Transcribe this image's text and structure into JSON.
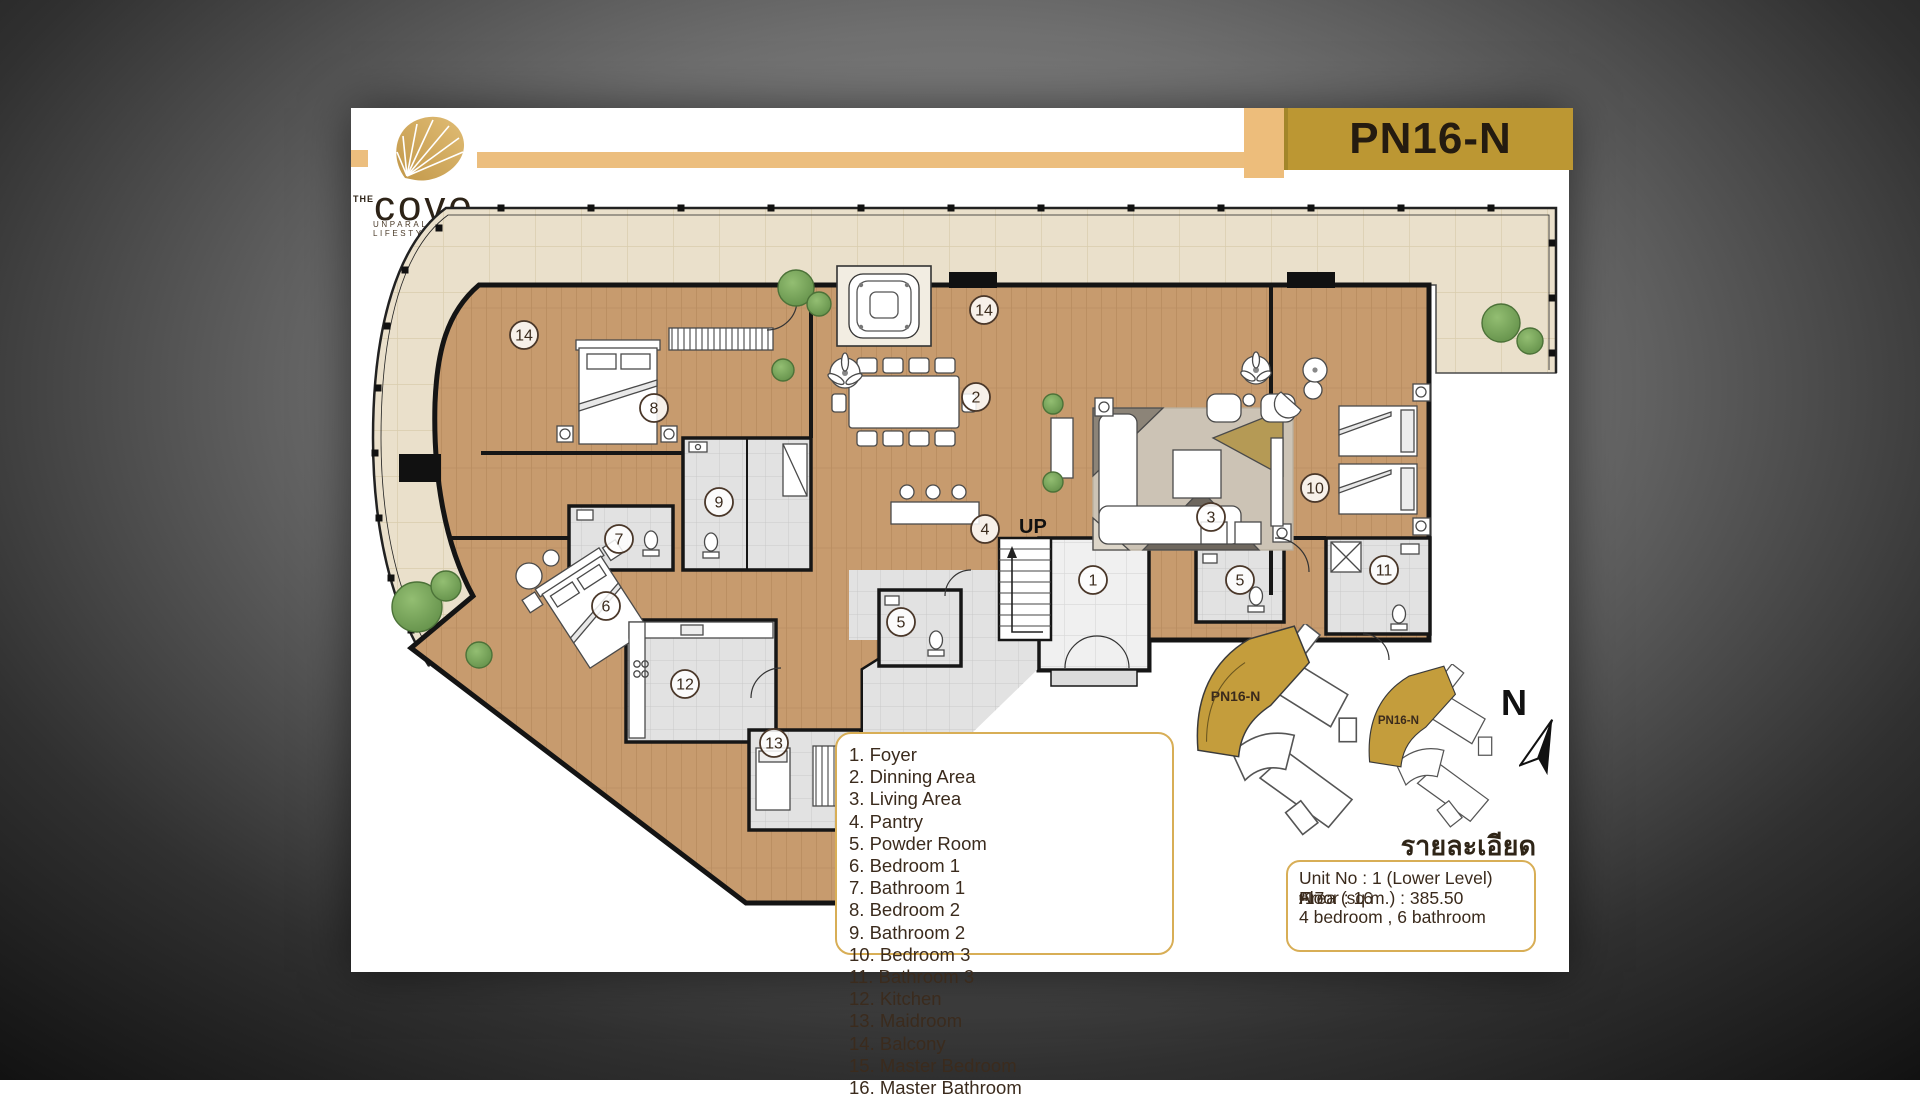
{
  "brand": {
    "the": "THE",
    "name": "cove",
    "tagline": "UNPARALLELED LIFESTYLE"
  },
  "unit_code": "PN16-N",
  "plan": {
    "up_label": "UP",
    "markers": [
      {
        "n": "14",
        "x": 173,
        "y": 227
      },
      {
        "n": "14",
        "x": 633,
        "y": 202
      },
      {
        "n": "8",
        "x": 303,
        "y": 300
      },
      {
        "n": "2",
        "x": 625,
        "y": 289
      },
      {
        "n": "3",
        "x": 860,
        "y": 409
      },
      {
        "n": "10",
        "x": 964,
        "y": 380
      },
      {
        "n": "9",
        "x": 368,
        "y": 394
      },
      {
        "n": "7",
        "x": 268,
        "y": 431
      },
      {
        "n": "6",
        "x": 255,
        "y": 498
      },
      {
        "n": "12",
        "x": 334,
        "y": 576
      },
      {
        "n": "13",
        "x": 423,
        "y": 635
      },
      {
        "n": "5",
        "x": 550,
        "y": 514
      },
      {
        "n": "5",
        "x": 889,
        "y": 472
      },
      {
        "n": "1",
        "x": 742,
        "y": 472
      },
      {
        "n": "4",
        "x": 634,
        "y": 421
      },
      {
        "n": "11",
        "x": 1033,
        "y": 462
      }
    ]
  },
  "legend": {
    "col1": [
      {
        "num": "1.",
        "label": "Foyer"
      },
      {
        "num": "2.",
        "label": "Dinning Area"
      },
      {
        "num": "3.",
        "label": "Living Area"
      },
      {
        "num": "4.",
        "label": "Pantry"
      },
      {
        "num": "5.",
        "label": "Powder Room"
      },
      {
        "num": "6.",
        "label": "Bedroom 1"
      },
      {
        "num": "7.",
        "label": "Bathroom 1"
      },
      {
        "num": "8.",
        "label": "Bedroom 2"
      },
      {
        "num": "9.",
        "label": "Bathroom 2"
      },
      {
        "num": "10.",
        "label": "Bedroom 3"
      }
    ],
    "col2": [
      {
        "num": "11.",
        "label": "Bathroom 3"
      },
      {
        "num": "12.",
        "label": "Kitchen"
      },
      {
        "num": "13.",
        "label": "Maidroom"
      },
      {
        "num": "14.",
        "label": "Balcony"
      },
      {
        "num": "15.",
        "label": "Master Bedroom"
      },
      {
        "num": "16.",
        "label": "Master Bathroom"
      }
    ]
  },
  "details": {
    "title": "รายละเอียด",
    "unit": "Unit No : 1 (Lower Level)",
    "floor_prefix": "Floor : 16",
    "floor_sup1": "th",
    "floor_mid": "-17",
    "floor_sup2": "th",
    "area": "Area (sq.m.) : 385.50",
    "rooms": "4 bedroom , 6 bathroom"
  },
  "keyplans": [
    {
      "label": "PN16-N"
    },
    {
      "label": "PN16-N"
    }
  ],
  "compass": {
    "label": "N"
  },
  "colors": {
    "gold_bar": "#ECBE7E",
    "unit_box": "#BC9733",
    "legend_border": "#D8AE56",
    "text_brown": "#3A2A1C",
    "wood": "#C79B6E",
    "balcony_tile": "#EAE0CB",
    "tile": "#E3E3E3",
    "keyplan_gold": "#C49D3C"
  }
}
